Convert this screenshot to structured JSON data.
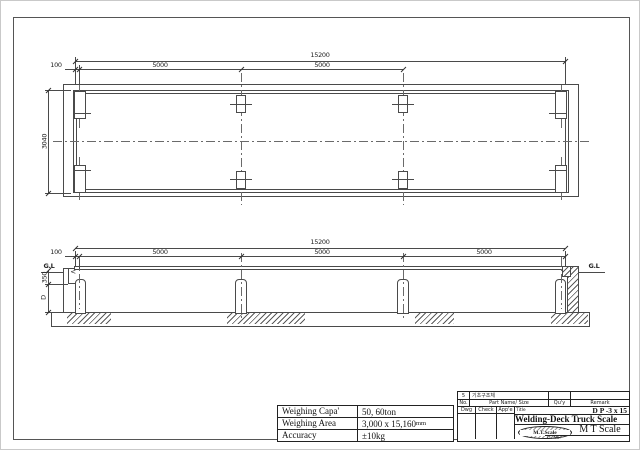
{
  "plan": {
    "dim_total": "15200",
    "dim_100": "100",
    "dim_span1": "5000",
    "dim_span2": "5000",
    "dim_width": "3040"
  },
  "elevation": {
    "dim_total": "15200",
    "dim_100": "100",
    "dim_span1": "5000",
    "dim_span2": "5000",
    "dim_span3": "5000",
    "gl_left": "G.L",
    "gl_right": "G.L",
    "dim_350": "350",
    "dim_depth": "D",
    "pointer": "<"
  },
  "spec_table": {
    "rows": [
      {
        "label": "Weighing Capa'",
        "value": "50, 60ton",
        "unit": ""
      },
      {
        "label": "Weighing Area",
        "value": "3,000 x 15,160",
        "unit": "mm"
      },
      {
        "label": "Accuracy",
        "value": "±10kg",
        "unit": ""
      }
    ]
  },
  "title_block": {
    "item_no": "5",
    "item_name": "기초구조체",
    "col_no": "No.",
    "col_part": "Part Name/ Size",
    "col_qty": "Qu'y",
    "col_remark": "Remark",
    "col_dwg": "Dwg",
    "col_check": "Check",
    "col_appe": "App'e",
    "title_label": "Title",
    "model": "D P -3 x 15",
    "drawing_title": "Welding-Deck Truck Scale",
    "company": "M T Scale",
    "logo_text": "M.T.Scale",
    "dno_label": "D. No."
  }
}
